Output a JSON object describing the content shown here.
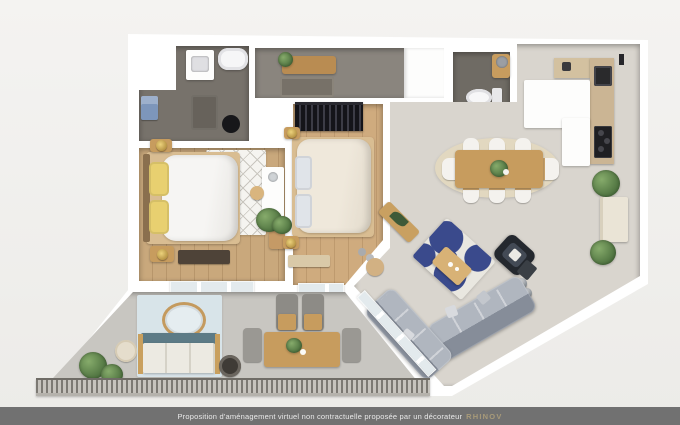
{
  "footer": {
    "text": "Proposition d'aménagement virtuel non contractuelle proposée par un décorateur",
    "brand": "RHINOV"
  },
  "scene": {
    "type": "3d-floor-plan-top-view",
    "rooms": [
      "bathroom",
      "hallway",
      "wc",
      "bedroom-1",
      "bedroom-2",
      "living-dining-room",
      "kitchen",
      "balcony"
    ]
  },
  "colors": {
    "background": "#f4f3f1",
    "wall": "#ffffff",
    "bath_floor": "#77726b",
    "hall_floor": "#8a857e",
    "wc_floor": "#6f6b64",
    "wood_floor": "#c9a87c",
    "wood_floor_2": "#cfab7e",
    "living_floor": "#d9d5ce",
    "balcony_floor": "#c8c6c1",
    "rug_blue": "#3a4a8c",
    "rug_white": "#e9e7e0",
    "sofa_gray": "#99a0aa",
    "armchair_dark": "#24282e",
    "wood_furniture": "#c79c5e",
    "accent_yellow": "#e8d070",
    "balcony_rug": "#d8e4e9",
    "outdoor_teal": "#5d7b86",
    "plant_green": "#4f7340",
    "footer_bg": "#717171",
    "footer_text": "#e9e9e9",
    "brand_gold": "#a89a79"
  }
}
